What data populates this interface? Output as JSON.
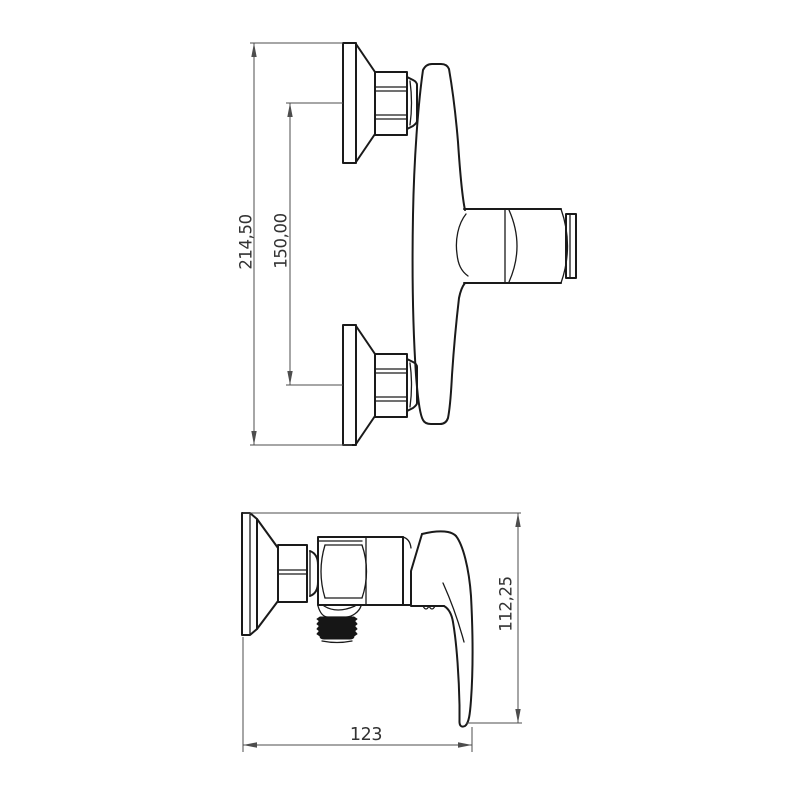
{
  "page": {
    "background_color": "#ffffff"
  },
  "drawing": {
    "type": "technical-dimension-drawing",
    "subject": "wall-mounted single-lever shower mixer tap, two orthographic views",
    "colors": {
      "outline": "#1a1a1a",
      "dimension_line": "#4d4d4d",
      "label": "#333333",
      "thread_fill": "#161616"
    },
    "views": {
      "side": {
        "name": "side-view-with-wall-connections"
      },
      "front": {
        "name": "front-view-with-lever-handle"
      }
    },
    "dimensions": {
      "total_height": "214,50",
      "port_spacing": "150,00",
      "depth": "112,25",
      "width": "123"
    }
  }
}
